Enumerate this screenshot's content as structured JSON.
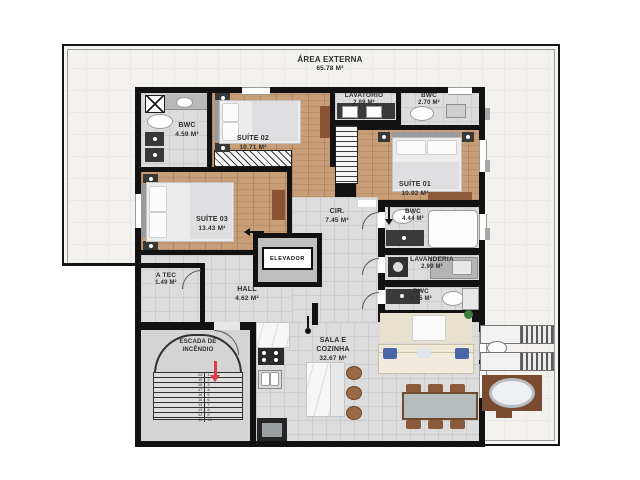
{
  "plan": {
    "outdoor": {
      "name": "ÁREA EXTERNA",
      "area": "65.78 m²"
    },
    "rooms": {
      "bwc1": {
        "name": "BWC",
        "area": "4.59 m²"
      },
      "suite2": {
        "name": "SUÍTE 02",
        "area": "10.71 m²"
      },
      "lavatorio": {
        "name": "LAVATORIO",
        "area": "2.89 m²"
      },
      "bwc2": {
        "name": "BWC",
        "area": "2.70 m²"
      },
      "suite1": {
        "name": "SUÍTE 01",
        "area": "10.92 m²"
      },
      "suite3": {
        "name": "SUÍTE 03",
        "area": "13.43 m²"
      },
      "cir": {
        "name": "CIR.",
        "area": "7.45 m²"
      },
      "bwc3": {
        "name": "BWC",
        "area": "4.44 m²"
      },
      "elevador": {
        "name": "ELEVADOR"
      },
      "lavanderia": {
        "name": "LAVANDERIA",
        "area": "2.99 m²"
      },
      "atec": {
        "name": "A TEC",
        "area": "1.49 m²"
      },
      "hall": {
        "name": "HALL",
        "area": "4.62 m²"
      },
      "bwc4": {
        "name": "BWC",
        "area": "3.05 m²"
      },
      "escada": {
        "name_line1": "ESCADA DE",
        "name_line2": "INCÊNDIO"
      },
      "sala": {
        "name_line1": "SALA E",
        "name_line2": "COZINHA",
        "area": "32.67 m²"
      }
    },
    "stairs": {
      "left": [
        "20",
        "19",
        "18",
        "17",
        "16",
        "15",
        "14",
        "13",
        "12",
        "11"
      ],
      "right": [
        "1",
        "2",
        "3",
        "4",
        "5",
        "6",
        "7",
        "8",
        "9",
        "10"
      ]
    },
    "colors": {
      "wall": "#121212",
      "wood_floor": "#c89e78",
      "tile_floor": "#dcdcdc",
      "outdoor_floor": "#f2f1ee",
      "stair_arrow": "#e23b4e"
    }
  }
}
